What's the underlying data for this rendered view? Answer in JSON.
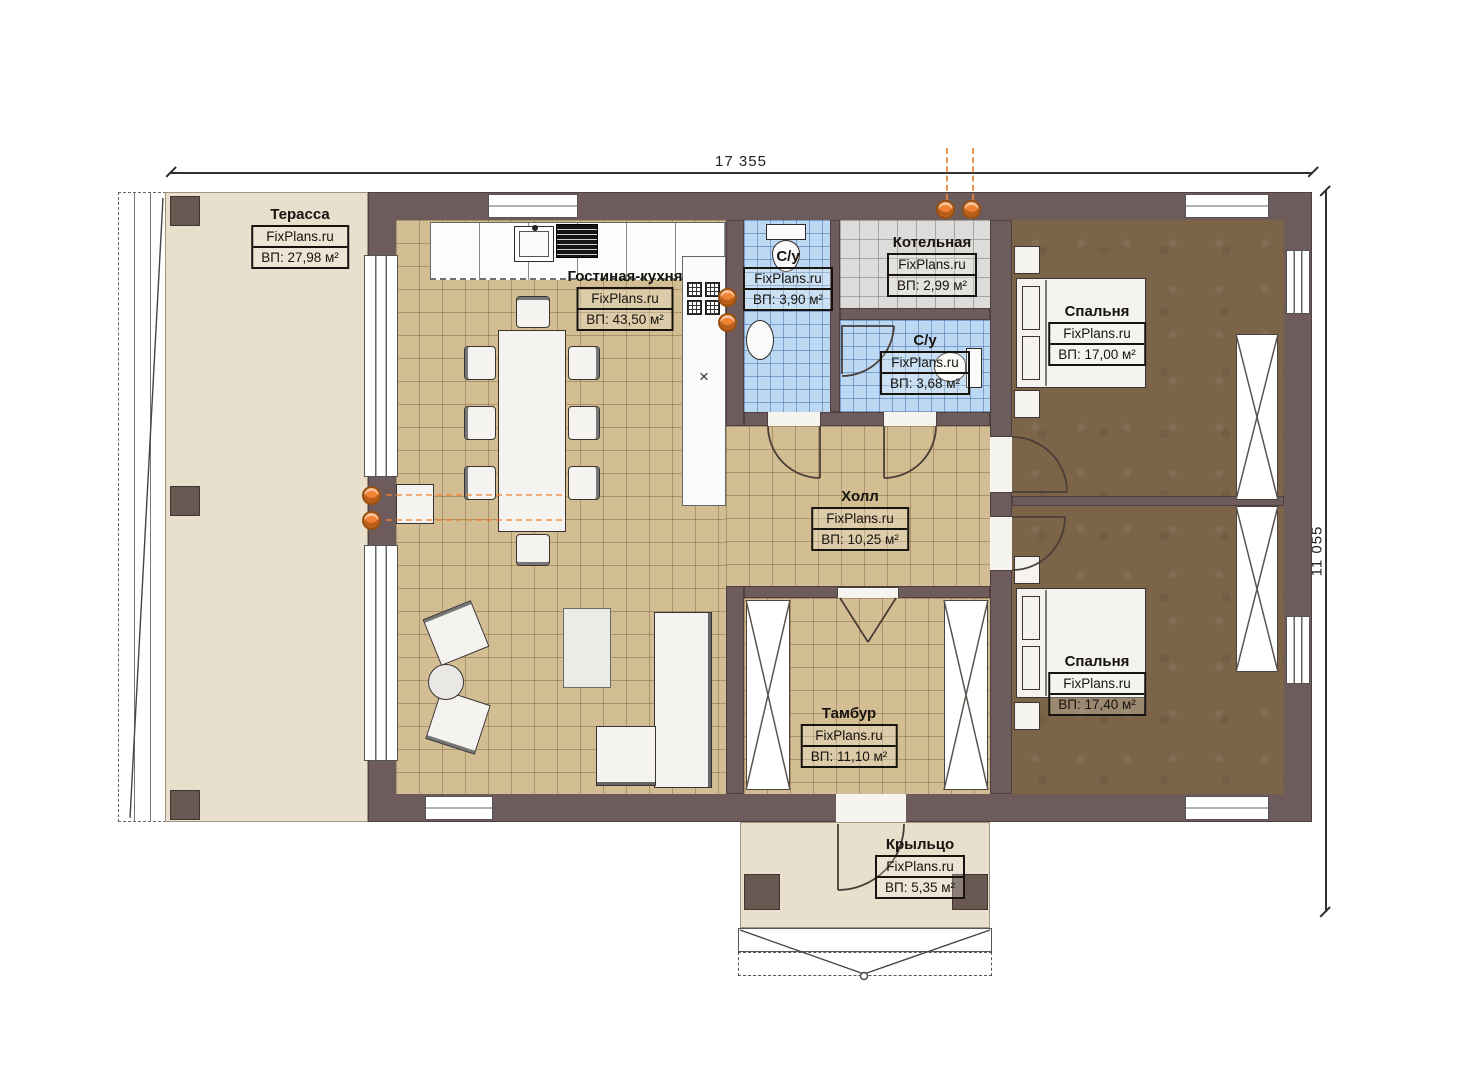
{
  "title": "FixPlans.ru floor plan",
  "dimensions": {
    "width_label": "17 355",
    "height_label": "11 055"
  },
  "symbols": {
    "cross_marker": "×"
  },
  "colors": {
    "wall": "#6e5c5c",
    "tan_tile": "#d3be94",
    "blue_tile": "#bdd8f2",
    "gray_tile": "#dddcda",
    "bedroom_floor": "#7c6449",
    "terrace_floor": "#e8dfcc",
    "heating_accent": "#f08233"
  },
  "rooms": [
    {
      "id": "terrace",
      "name": "Терасса",
      "brand": "FixPlans.ru",
      "area": "ВП: 27,98 м²"
    },
    {
      "id": "living",
      "name": "Гостиная-кухня",
      "brand": "FixPlans.ru",
      "area": "ВП: 43,50 м²"
    },
    {
      "id": "wc1",
      "name": "С/у",
      "brand": "FixPlans.ru",
      "area": "ВП: 3,90 м²"
    },
    {
      "id": "boiler",
      "name": "Котельная",
      "brand": "FixPlans.ru",
      "area": "ВП: 2,99 м²"
    },
    {
      "id": "wc2",
      "name": "С/у",
      "brand": "FixPlans.ru",
      "area": "ВП: 3,68 м²"
    },
    {
      "id": "bedroom1",
      "name": "Спальня",
      "brand": "FixPlans.ru",
      "area": "ВП: 17,00 м²"
    },
    {
      "id": "hall",
      "name": "Холл",
      "brand": "FixPlans.ru",
      "area": "ВП: 10,25 м²"
    },
    {
      "id": "bedroom2",
      "name": "Спальня",
      "brand": "FixPlans.ru",
      "area": "ВП: 17,40 м²"
    },
    {
      "id": "tambour",
      "name": "Тамбур",
      "brand": "FixPlans.ru",
      "area": "ВП: 11,10 м²"
    },
    {
      "id": "porch",
      "name": "Крыльцо",
      "brand": "FixPlans.ru",
      "area": "ВП: 5,35 м²"
    }
  ]
}
